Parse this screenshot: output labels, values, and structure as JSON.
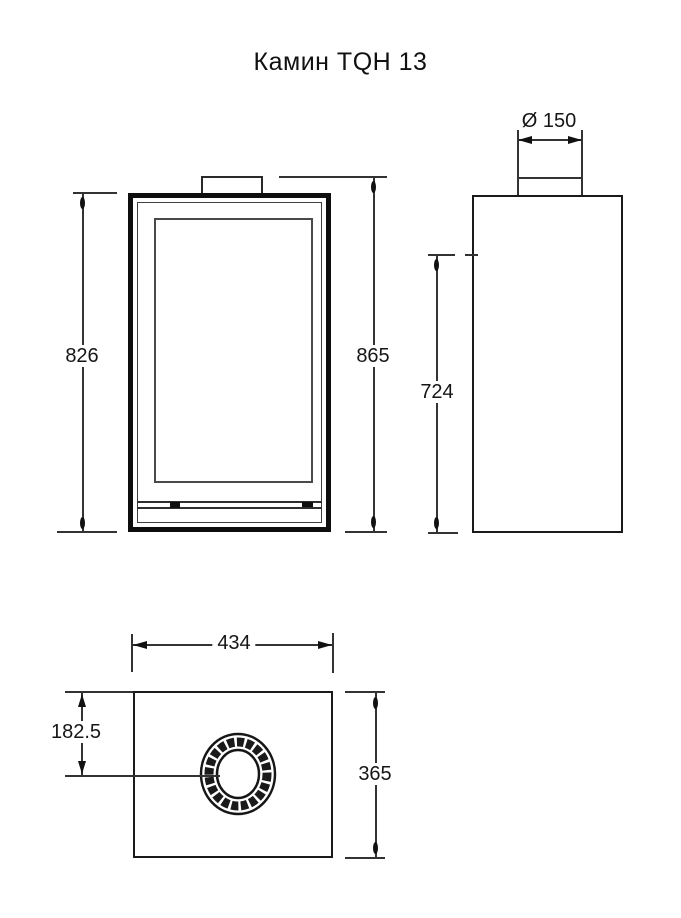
{
  "title": "Камин TQH 13",
  "dimensions": {
    "body_height": "826",
    "overall_height": "865",
    "flue_diameter": "Ø 150",
    "side_height": "724",
    "width": "434",
    "depth": "365",
    "flue_offset": "182.5"
  },
  "colors": {
    "outline": "#1a1a1a",
    "dimension_line": "#2e2e2e",
    "glass_line": "#4a4a4a",
    "background": "#ffffff"
  }
}
